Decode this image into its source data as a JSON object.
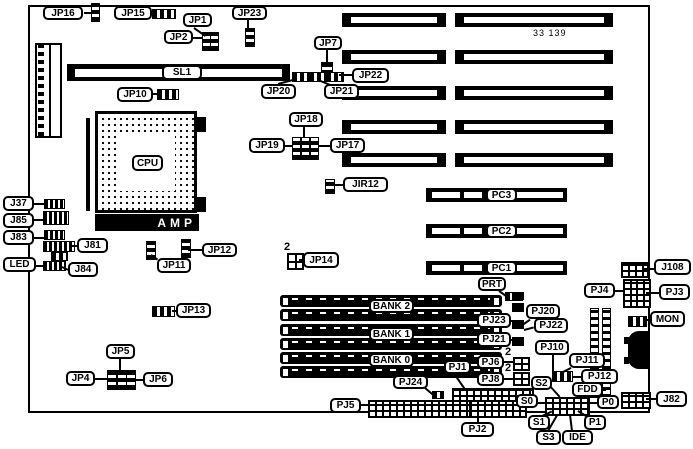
{
  "board_number": "33 139",
  "labels": {
    "jp16": "JP16",
    "jp15": "JP15",
    "jp1": "JP1",
    "jp2": "JP2",
    "jp23": "JP23",
    "jp7": "JP7",
    "sl1": "SL1",
    "jp10": "JP10",
    "jp20": "JP20",
    "jp21": "JP21",
    "jp22": "JP22",
    "jp18": "JP18",
    "jp19": "JP19",
    "jp17": "JP17",
    "jir12": "JIR12",
    "cpu": "CPU",
    "amp": "AMP",
    "j37": "J37",
    "j85": "J85",
    "j83": "J83",
    "j81": "J81",
    "led": "LED",
    "j84": "J84",
    "jp12": "JP12",
    "jp11": "JP11",
    "jp14": "JP14",
    "jp13": "JP13",
    "pc3": "PC3",
    "pc2": "PC2",
    "pc1": "PC1",
    "prt": "PRT",
    "bank2": "BANK 2",
    "bank1": "BANK 1",
    "bank0": "BANK 0",
    "pj20": "PJ20",
    "pj22": "PJ22",
    "pj23": "PJ23",
    "pj21": "PJ21",
    "pj6": "PJ6",
    "pj8": "PJ8",
    "pj1": "PJ1",
    "pj24": "PJ24",
    "pj10": "PJ10",
    "pj11": "PJ11",
    "pj12": "PJ12",
    "s2": "S2",
    "s0": "S0",
    "s1": "S1",
    "s3": "S3",
    "ide": "IDE",
    "p0": "P0",
    "p1": "P1",
    "fdd": "FDD",
    "pj5": "PJ5",
    "pj2": "PJ2",
    "jp5": "JP5",
    "jp4": "JP4",
    "jp6": "JP6",
    "j108": "J108",
    "pj4": "PJ4",
    "pj3": "PJ3",
    "mon": "MON",
    "j82": "J82"
  },
  "markers": {
    "jp14_pin2": "2",
    "pj6_pin2": "2",
    "pj8_pin2": "2"
  }
}
